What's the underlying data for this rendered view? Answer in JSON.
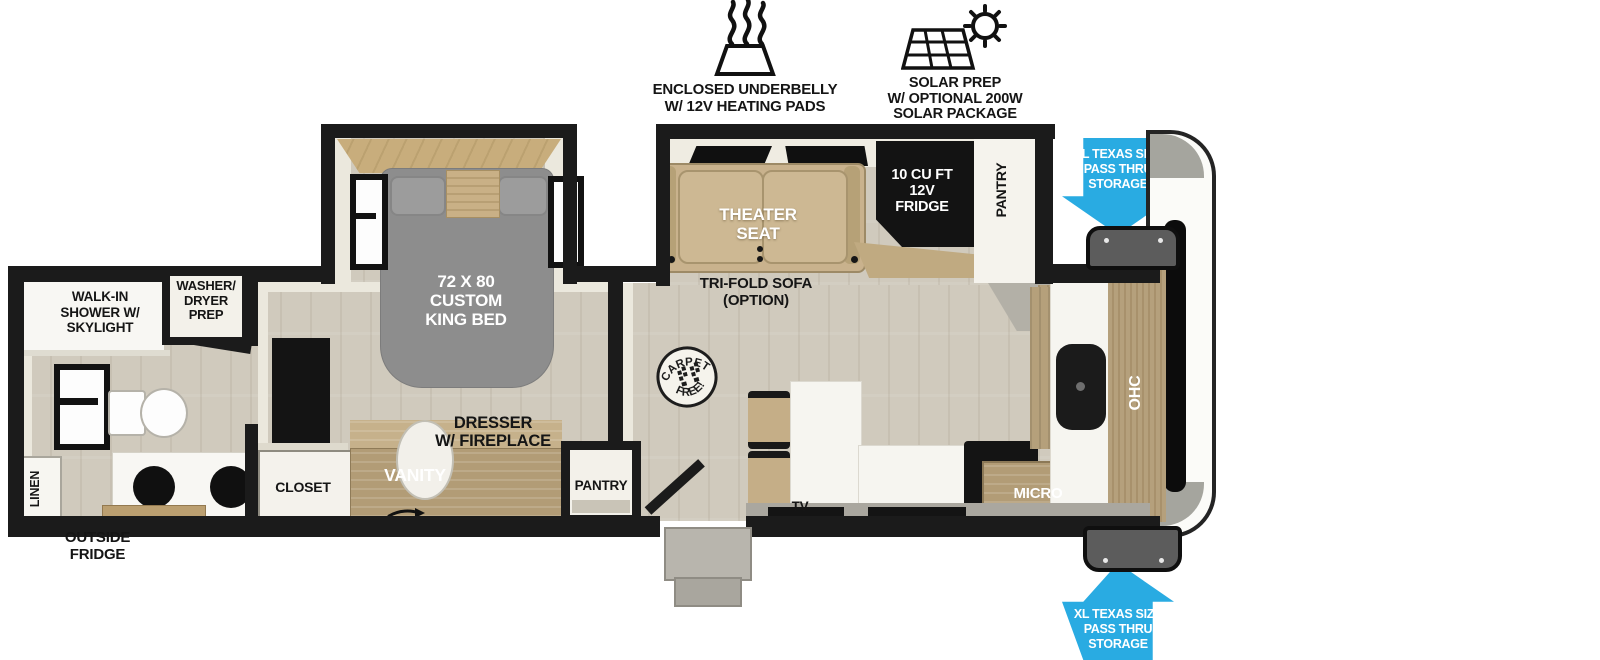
{
  "title": "Travel trailer floor plan",
  "colors": {
    "accent_blue": "#29ABE2",
    "wall_black": "#1b1b1b",
    "bed_gray": "#8d8d8d",
    "wood_tan": "#b29c76",
    "seat_tan": "#c9b28d",
    "floor_beige": "#d0cabd"
  },
  "legend": {
    "underbelly": {
      "icon": "heating-pad-icon",
      "lines": [
        "ENCLOSED UNDERBELLY",
        "W/ 12V HEATING PADS"
      ]
    },
    "solar": {
      "icon": "solar-panel-icon",
      "lines": [
        "SOLAR PREP",
        "W/ OPTIONAL 200W",
        "SOLAR PACKAGE"
      ]
    }
  },
  "storage_callout": {
    "lines": [
      "XL TEXAS SIZE",
      "PASS THRU",
      "STORAGE"
    ]
  },
  "exterior": {
    "outside_fridge": {
      "lines": [
        "OUTSIDE",
        "FRIDGE"
      ]
    }
  },
  "bathroom": {
    "shower": {
      "lines": [
        "WALK-IN",
        "SHOWER W/",
        "SKYLIGHT"
      ]
    },
    "washer_dryer": {
      "lines": [
        "WASHER/",
        "DRYER",
        "PREP"
      ]
    },
    "linen": "LINEN"
  },
  "bedroom": {
    "closet": "CLOSET",
    "vanity": "VANITY",
    "dresser": {
      "lines": [
        "DRESSER",
        "W/ FIREPLACE"
      ]
    },
    "bed": {
      "lines": [
        "72 X 80",
        "CUSTOM",
        "KING BED"
      ]
    },
    "pantry": "PANTRY"
  },
  "living": {
    "theater_seat": {
      "lines": [
        "THEATER",
        "SEAT"
      ]
    },
    "trifold_sofa": {
      "lines": [
        "TRI-FOLD SOFA",
        "(OPTION)"
      ]
    },
    "fridge": {
      "lines": [
        "10 CU FT",
        "12V",
        "FRIDGE"
      ]
    },
    "pantry": "PANTRY",
    "carpet_free": {
      "top": "CARPET",
      "bottom": "FREE!"
    },
    "tv": "TV"
  },
  "kitchen": {
    "micro": "MICRO",
    "ohc": "OHC"
  }
}
